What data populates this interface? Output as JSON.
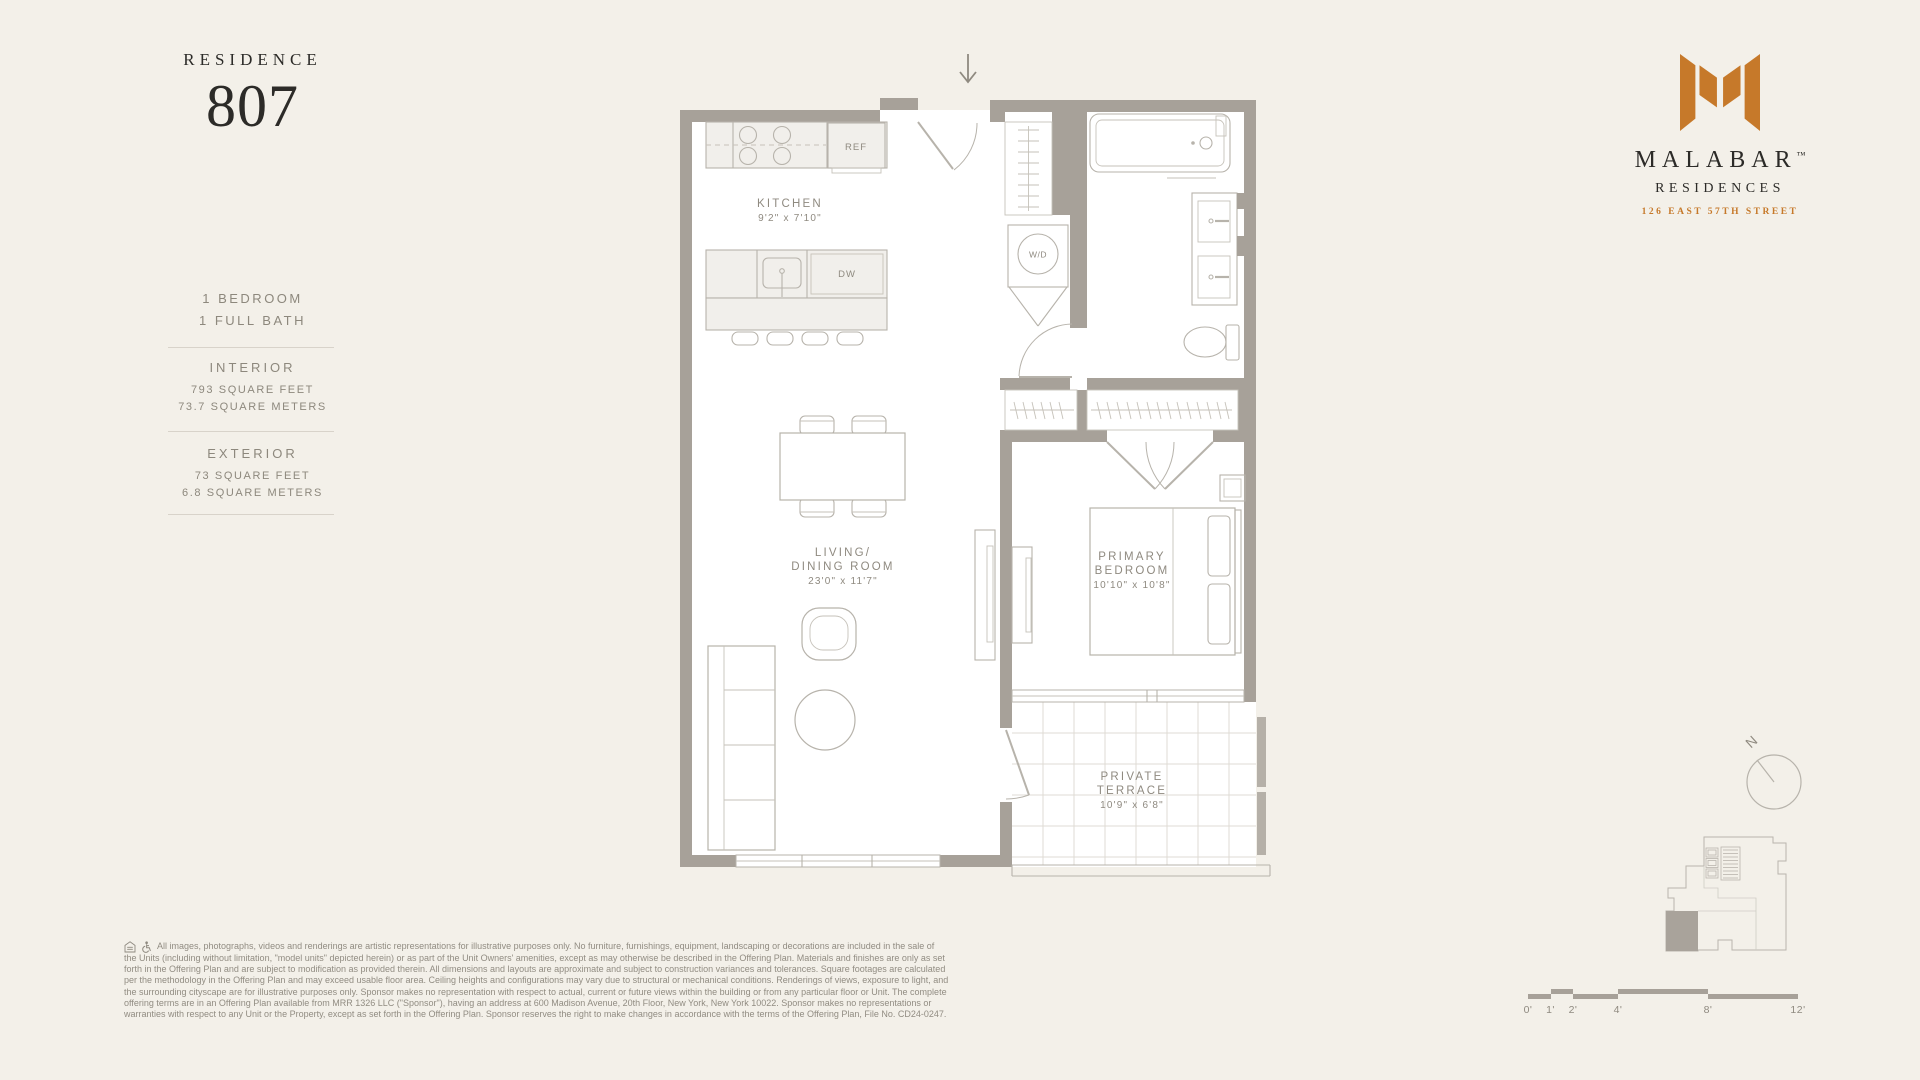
{
  "residence": {
    "label": "RESIDENCE",
    "number": "807"
  },
  "unit": {
    "line1": "1 BEDROOM",
    "line2": "1 FULL BATH"
  },
  "interior": {
    "title": "INTERIOR",
    "sqft": "793 SQUARE FEET",
    "sqm": "73.7 SQUARE METERS"
  },
  "exterior": {
    "title": "EXTERIOR",
    "sqft": "73 SQUARE FEET",
    "sqm": "6.8 SQUARE METERS"
  },
  "brand": {
    "name": "MALABAR",
    "tm": "™",
    "type": "RESIDENCES",
    "address": "126 EAST 57TH STREET",
    "accent_color": "#c6792a"
  },
  "plan": {
    "kitchen": {
      "name": "KITCHEN",
      "dims": "9'2\" x 7'10\""
    },
    "living": {
      "name1": "LIVING/",
      "name2": "DINING ROOM",
      "dims": "23'0\" x 11'7\""
    },
    "bedroom": {
      "name1": "PRIMARY",
      "name2": "BEDROOM",
      "dims": "10'10\" x 10'8\""
    },
    "terrace": {
      "name1": "PRIVATE",
      "name2": "TERRACE",
      "dims": "10'9\" x 6'8\""
    },
    "labels": {
      "ref": "REF",
      "dw": "DW",
      "wd": "W/D"
    },
    "wall_color": "#a7a199"
  },
  "compass": {
    "n": "N"
  },
  "scalebar": {
    "labels": [
      "0'",
      "1'",
      "2'",
      "4'",
      "8'",
      "12'"
    ]
  },
  "disclaimer": {
    "lines": [
      "All images, photographs, videos and renderings are artistic representations for illustrative purposes only. No furniture, furnishings, equipment, landscaping or decorations are included in the sale of",
      "the Units (including without limitation, \"model units\" depicted herein) or as part of the Unit Owners' amenities, except as may otherwise be described in the Offering Plan. Materials and finishes are only as set",
      "forth in the Offering Plan and are subject to modification as provided therein. All dimensions and layouts are approximate and subject to construction variances and tolerances. Square footages are calculated",
      "per the methodology in the Offering Plan and may exceed usable floor area. Ceiling heights and configurations may vary due to structural or mechanical conditions. Renderings of views, exposure to light, and",
      "the surrounding cityscape are for illustrative purposes only. Sponsor makes no representation with respect to actual, current or future views within the building or from any particular floor or Unit. The complete",
      "offering terms are in an Offering Plan available from MRR 1326 LLC (\"Sponsor\"), having an address at 600 Madison Avenue, 20th Floor, New York, New York 10022. Sponsor makes no representations or",
      "warranties with respect to any Unit or the Property, except as set forth in the Offering Plan. Sponsor reserves the right to make changes in accordance with the terms of the Offering Plan, File No. CD24-0247."
    ]
  }
}
